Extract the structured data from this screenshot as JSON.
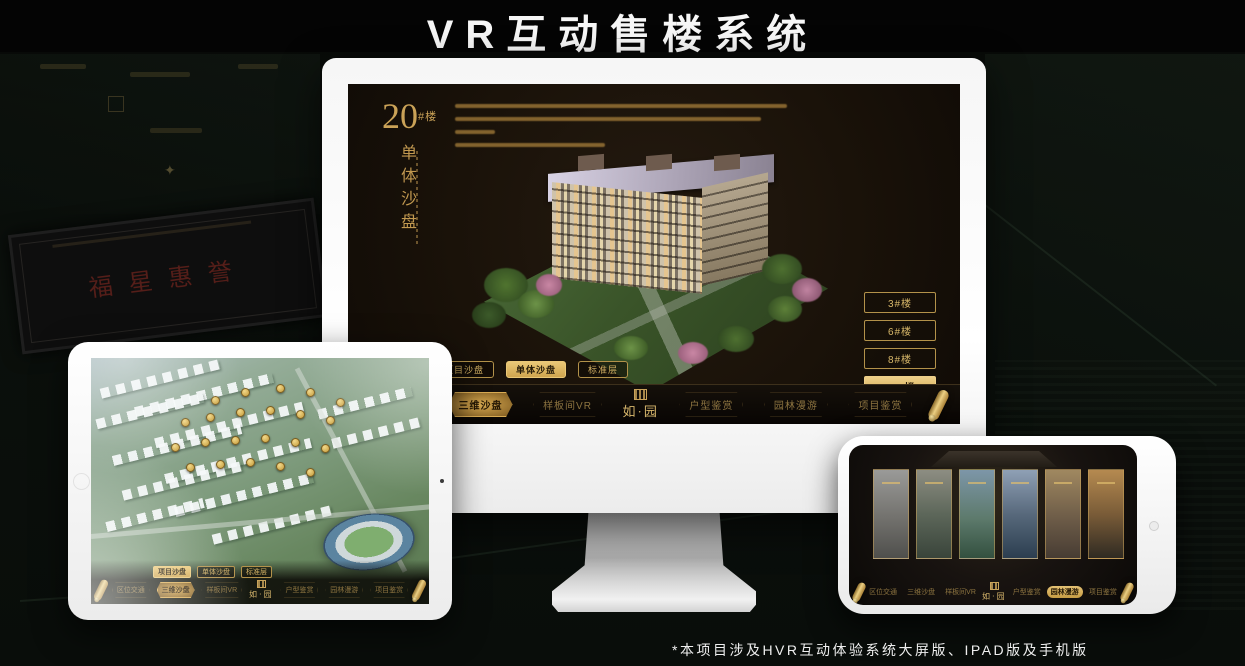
{
  "page": {
    "title": "VR互动售楼系统",
    "footnote": "*本项目涉及HVR互动体验系统大屏版、IPAD版及手机版"
  },
  "colors": {
    "gold": "#C9A35A",
    "gold_bright": "#EAC877",
    "screen_bg": "#1A1209",
    "page_bg": "#0B100C"
  },
  "background": {
    "plaque_text": "福星惠誉"
  },
  "monitor": {
    "heading": {
      "number": "20",
      "suffix": "#楼",
      "subtitle_vertical": "单体沙盘"
    },
    "floor_buttons": [
      {
        "label": "3#楼",
        "active": false
      },
      {
        "label": "6#楼",
        "active": false
      },
      {
        "label": "8#楼",
        "active": false
      },
      {
        "label": "20#楼",
        "active": true
      }
    ],
    "view_tabs": [
      {
        "label": "项目沙盘",
        "active": false
      },
      {
        "label": "单体沙盘",
        "active": true
      },
      {
        "label": "标准层",
        "active": false
      }
    ],
    "nav_left": [
      {
        "label": "区位交通",
        "active": false
      },
      {
        "label": "三维沙盘",
        "active": true
      },
      {
        "label": "样板间VR",
        "active": false
      }
    ],
    "logo": "如·园",
    "nav_right": [
      {
        "label": "户型鉴赏",
        "active": false
      },
      {
        "label": "园林漫游",
        "active": false
      },
      {
        "label": "项目鉴赏",
        "active": false
      }
    ]
  },
  "tablet": {
    "view_tabs": [
      {
        "label": "项目沙盘",
        "active": true
      },
      {
        "label": "单体沙盘",
        "active": false
      },
      {
        "label": "标准层",
        "active": false
      }
    ],
    "nav_left": [
      {
        "label": "区位交通",
        "active": false
      },
      {
        "label": "三维沙盘",
        "active": true
      },
      {
        "label": "样板间VR",
        "active": false
      }
    ],
    "logo": "如·园",
    "nav_right": [
      {
        "label": "户型鉴赏",
        "active": false
      },
      {
        "label": "园林漫游",
        "active": false
      },
      {
        "label": "项目鉴赏",
        "active": false
      }
    ]
  },
  "phone": {
    "gallery_panel_count": 6,
    "nav_left": [
      {
        "label": "区位交通",
        "active": false
      },
      {
        "label": "三维沙盘",
        "active": false
      },
      {
        "label": "样板间VR",
        "active": false
      }
    ],
    "logo": "如·园",
    "nav_right": [
      {
        "label": "户型鉴赏",
        "active": false
      },
      {
        "label": "园林漫游",
        "active": true
      },
      {
        "label": "项目鉴赏",
        "active": false
      }
    ]
  }
}
